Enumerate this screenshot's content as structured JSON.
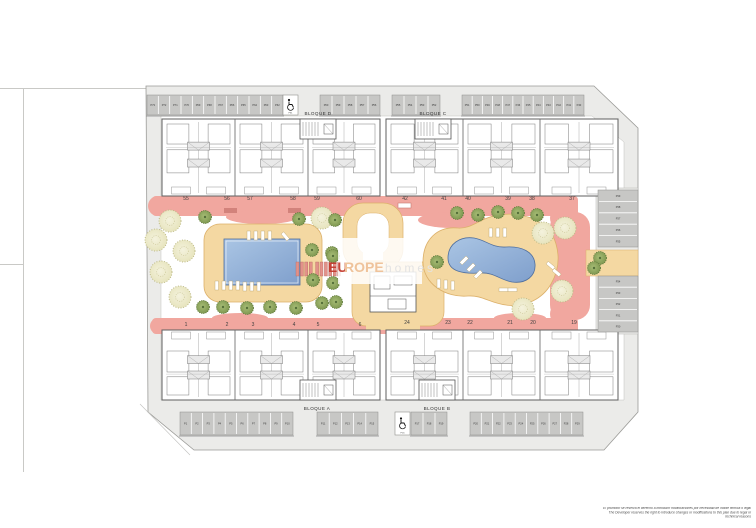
{
  "site": {
    "blocks": {
      "d": "BLOQUE D",
      "c": "BLOQUE C",
      "a": "BLOQUE A",
      "b": "BLOQUE B"
    },
    "unit_numbers": {
      "top_left": [
        "55",
        "56",
        "57",
        "58",
        "59",
        "60"
      ],
      "top_right": [
        "42",
        "41",
        "40",
        "39",
        "38",
        "37"
      ],
      "bottom_left": [
        "1",
        "2",
        "3",
        "4",
        "5",
        "6"
      ],
      "bottom_right": [
        "24",
        "23",
        "22",
        "21",
        "20",
        "19"
      ]
    },
    "parking": {
      "top_row_main": [
        "P73",
        "P72",
        "P71",
        "P70",
        "P69",
        "P68",
        "P67",
        "P66",
        "P65",
        "P64",
        "P63",
        "P62"
      ],
      "handicap_top": "P61",
      "top_row_small": [
        "P60",
        "P59",
        "P58",
        "P57",
        "P56"
      ],
      "top_right_small": [
        "P55",
        "P54",
        "P53",
        "P52"
      ],
      "top_right_main": [
        "P51",
        "P50",
        "P49",
        "P48",
        "P47",
        "P46",
        "P45",
        "P44",
        "P43",
        "P42",
        "P41",
        "P40"
      ],
      "right_upper": [
        "P39",
        "P38",
        "P37",
        "P36",
        "P35"
      ],
      "right_lower": [
        "P34",
        "P33",
        "P32",
        "P31",
        "P30"
      ],
      "bottom_right_main": [
        "P20",
        "P21",
        "P22",
        "P23",
        "P24",
        "P25",
        "P26",
        "P27",
        "P28",
        "P29"
      ],
      "bottom_right_small": [
        "P17",
        "P18",
        "P19"
      ],
      "handicap_bottom": "P16",
      "bottom_left_small": [
        "P11",
        "P12",
        "P13",
        "P14",
        "P15"
      ],
      "bottom_left_main": [
        "P1",
        "P2",
        "P3",
        "P4",
        "P5",
        "P6",
        "P7",
        "P8",
        "P9",
        "P10"
      ]
    },
    "icons": {
      "handicap": "wheelchair"
    }
  },
  "watermark": {
    "part_bold": "EU",
    "part_mid": "ROPE",
    "part_light": "homes"
  },
  "disclaimer": {
    "line_es": "El promotor se reserva el derecho a introducir modificaciones por necesidad de índole técnica o legal",
    "line_en": "The Developer reserves the right to introduce changes or modifications to this plan due to legal or technical reasons"
  },
  "colors": {
    "path_pink": "#f1a79f",
    "deck_tan": "#f4d8a2",
    "pool_blue": "#8fb0d9",
    "sidewalk": "#ebebe9",
    "stall_gray": "#c7c7c5",
    "wall_gray": "#5a5a5a",
    "tree_light": "#edebc9",
    "tree_dark": "#8fa75f",
    "watermark_red": "#c43c30",
    "watermark_peach": "#efc39b"
  }
}
